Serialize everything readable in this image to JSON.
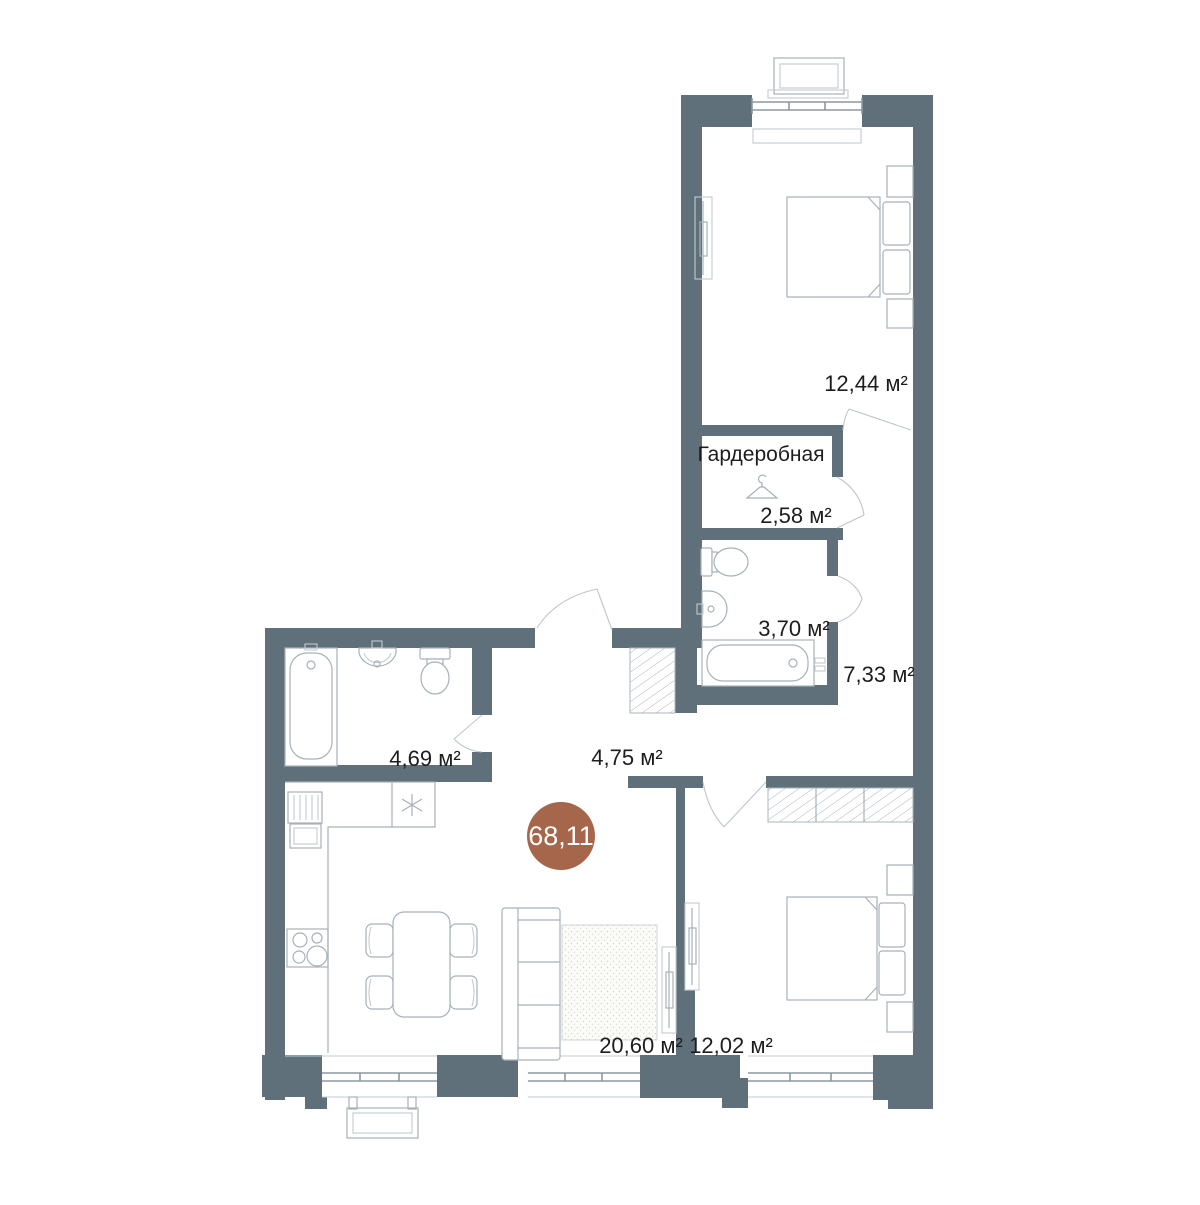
{
  "floorplan": {
    "badge": {
      "total_area": "68,11"
    },
    "rooms": {
      "bedroom_top": {
        "area": "12,44 м²"
      },
      "wardrobe": {
        "name": "Гардеробная",
        "area": "2,58 м²"
      },
      "bathroom_small": {
        "area": "3,70 м²"
      },
      "hall": {
        "area": "7,33 м²"
      },
      "bathroom_large": {
        "area": "4,69 м²"
      },
      "hallway": {
        "area": "4,75 м²"
      },
      "kitchen_living": {
        "area": "20,60 м²"
      },
      "bedroom_bottom": {
        "area": "12,02 м²"
      }
    },
    "colors": {
      "wall": "#5f707b",
      "badge_circle": "#a5664b",
      "fixture_stroke": "#a6b1b8",
      "label_text": "#1d1d1d"
    }
  }
}
